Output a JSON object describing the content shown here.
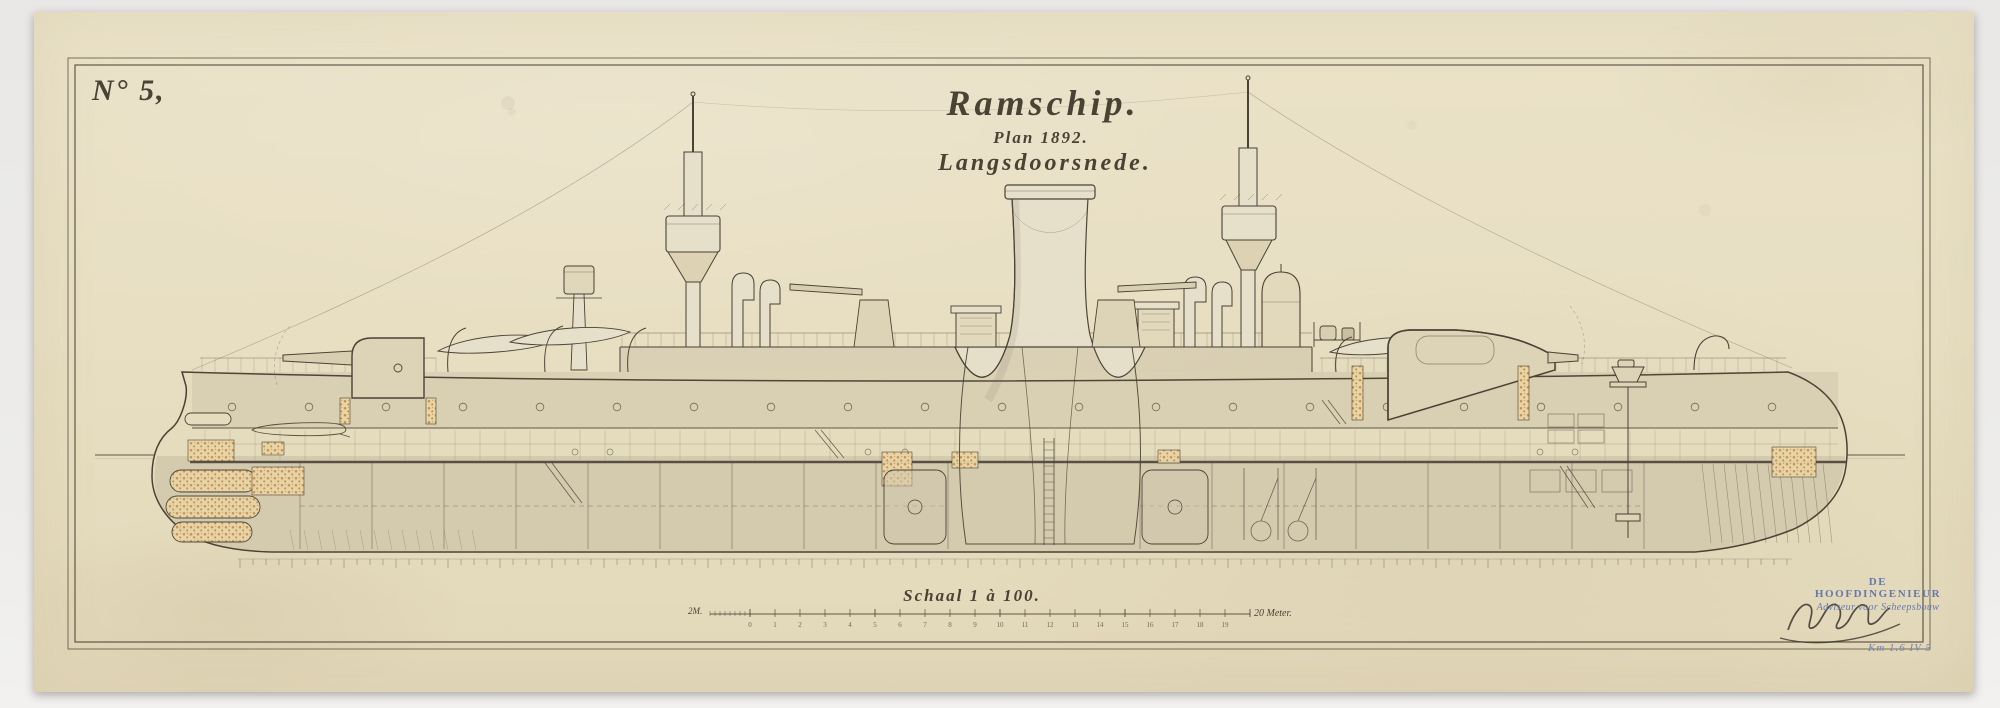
{
  "document": {
    "sheet_number": "N° 5,",
    "title": "Ramschip.",
    "subtitle": "Plan 1892.",
    "view_label": "Langsdoorsnede.",
    "scale_label": "Schaal 1 à 100.",
    "scale_bar": {
      "left_label": "2M.",
      "meters": 20,
      "end_label": "20 Meter."
    },
    "stamp": {
      "line1": "DE HOOFDINGENIEUR",
      "line2": "Adviseur voor Scheepsbouw"
    },
    "archive_note": "Km 1.6 IV 5"
  },
  "colors": {
    "paper": "#e8dfc3",
    "ink": "#4a4234",
    "stamp_blue": "#6678ad",
    "note_blue": "#7484b8",
    "cork_orange": "#c4823e",
    "hull_fill": "#e5dcbe"
  },
  "drawing": {
    "type": "ship-longitudinal-section",
    "parts": [
      "ram-bow",
      "hull",
      "main-deck",
      "armour-deck",
      "waterline",
      "keel",
      "funnel",
      "fore-fighting-mast",
      "aft-fighting-mast",
      "conning-tower",
      "searchlight",
      "ventilation-cowls",
      "ships-boats",
      "bow-gun",
      "stern-gun",
      "quick-fire-guns",
      "boilers",
      "engine",
      "capstan",
      "stern-frames",
      "cork-cells",
      "station-scale"
    ]
  }
}
